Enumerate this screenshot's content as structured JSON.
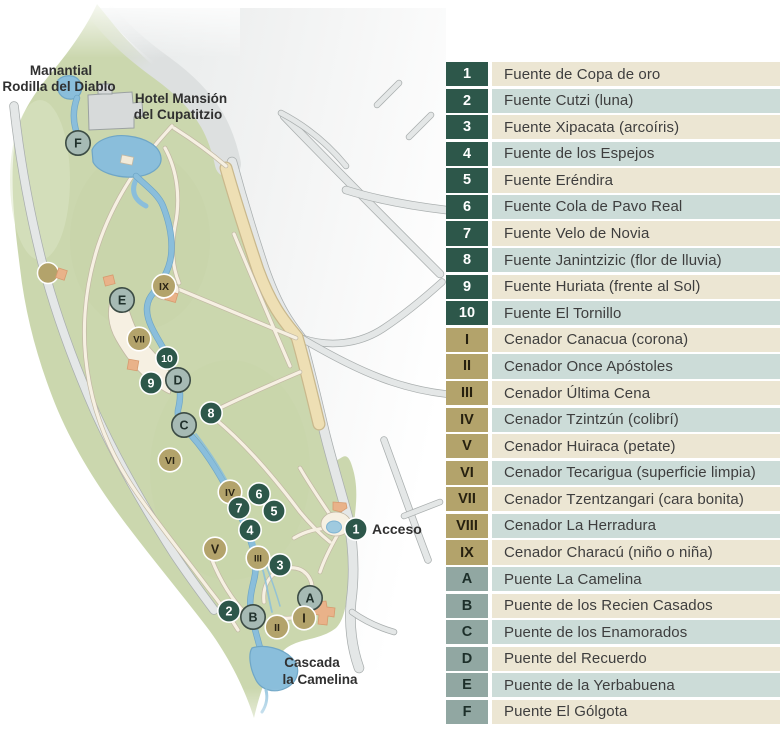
{
  "colors": {
    "fuente_badge": "#2d574a",
    "cenador_badge": "#b3a36b",
    "puente_badge": "#91a7a2",
    "puente_marker": "#a6bab4",
    "row_teal": "#ccdcd8",
    "row_cream": "#ece6d3",
    "park_green": "#cbd7ae",
    "river_blue": "#8abedb",
    "road_gray": "#e4e7e7",
    "avenue_beige": "#eedfb4",
    "building_orange": "#e9b289"
  },
  "legend": {
    "items": [
      {
        "badge": "1",
        "type": "fuente",
        "label": "Fuente de Copa de oro"
      },
      {
        "badge": "2",
        "type": "fuente",
        "label": "Fuente Cutzi (luna)"
      },
      {
        "badge": "3",
        "type": "fuente",
        "label": "Fuente Xipacata (arcoíris)"
      },
      {
        "badge": "4",
        "type": "fuente",
        "label": "Fuente de los Espejos"
      },
      {
        "badge": "5",
        "type": "fuente",
        "label": "Fuente Eréndira"
      },
      {
        "badge": "6",
        "type": "fuente",
        "label": "Fuente Cola de Pavo Real"
      },
      {
        "badge": "7",
        "type": "fuente",
        "label": "Fuente Velo de Novia"
      },
      {
        "badge": "8",
        "type": "fuente",
        "label": "Fuente Janintzizic (flor de lluvia)"
      },
      {
        "badge": "9",
        "type": "fuente",
        "label": "Fuente Huriata (frente al Sol)"
      },
      {
        "badge": "10",
        "type": "fuente",
        "label": "Fuente El Tornillo"
      },
      {
        "badge": "I",
        "type": "cenador",
        "label": "Cenador Canacua (corona)"
      },
      {
        "badge": "II",
        "type": "cenador",
        "label": "Cenador Once Apóstoles"
      },
      {
        "badge": "III",
        "type": "cenador",
        "label": "Cenador Última Cena"
      },
      {
        "badge": "IV",
        "type": "cenador",
        "label": "Cenador Tzintzún (colibrí)"
      },
      {
        "badge": "V",
        "type": "cenador",
        "label": "Cenador Huiraca (petate)"
      },
      {
        "badge": "VI",
        "type": "cenador",
        "label": "Cenador Tecarigua (superficie limpia)"
      },
      {
        "badge": "VII",
        "type": "cenador",
        "label": "Cenador Tzentzangari (cara bonita)"
      },
      {
        "badge": "VIII",
        "type": "cenador",
        "label": "Cenador La Herradura"
      },
      {
        "badge": "IX",
        "type": "cenador",
        "label": "Cenador Characú (niño o niña)"
      },
      {
        "badge": "A",
        "type": "puente",
        "label": "Puente La Camelina"
      },
      {
        "badge": "B",
        "type": "puente",
        "label": "Puente de los Recien Casados"
      },
      {
        "badge": "C",
        "type": "puente",
        "label": "Puente de los Enamorados"
      },
      {
        "badge": "D",
        "type": "puente",
        "label": "Puente del Recuerdo"
      },
      {
        "badge": "E",
        "type": "puente",
        "label": "Puente de la Yerbabuena"
      },
      {
        "badge": "F",
        "type": "puente",
        "label": "Puente El Gólgota"
      }
    ]
  },
  "map": {
    "labels": {
      "manantial_line1": "Manantial",
      "manantial_line2": "Rodilla del Diablo",
      "hotel_line1": "Hotel Mansión",
      "hotel_line2": "del Cupatitzio",
      "acceso": "Acceso",
      "cascada_line1": "Cascada",
      "cascada_line2": "la Camelina"
    },
    "markers": [
      {
        "id": "F",
        "type": "puente",
        "x": 78,
        "y": 143
      },
      {
        "id": "E",
        "type": "puente",
        "x": 122,
        "y": 300
      },
      {
        "id": "IX",
        "type": "cenador",
        "x": 164,
        "y": 286
      },
      {
        "id": "VII",
        "type": "cenador",
        "x": 139,
        "y": 339
      },
      {
        "id": "10",
        "type": "fuente",
        "x": 167,
        "y": 358
      },
      {
        "id": "D",
        "type": "puente",
        "x": 178,
        "y": 380
      },
      {
        "id": "9",
        "type": "fuente",
        "x": 151,
        "y": 383
      },
      {
        "id": "8",
        "type": "fuente",
        "x": 211,
        "y": 413
      },
      {
        "id": "C",
        "type": "puente",
        "x": 184,
        "y": 425
      },
      {
        "id": "VI",
        "type": "cenador",
        "x": 170,
        "y": 460
      },
      {
        "id": "IV",
        "type": "cenador",
        "x": 230,
        "y": 492
      },
      {
        "id": "6",
        "type": "fuente",
        "x": 259,
        "y": 494
      },
      {
        "id": "5",
        "type": "fuente",
        "x": 274,
        "y": 511
      },
      {
        "id": "7",
        "type": "fuente",
        "x": 239,
        "y": 508
      },
      {
        "id": "4",
        "type": "fuente",
        "x": 250,
        "y": 530
      },
      {
        "id": "1",
        "type": "fuente",
        "x": 356,
        "y": 529
      },
      {
        "id": "V",
        "type": "cenador",
        "x": 215,
        "y": 549
      },
      {
        "id": "III",
        "type": "cenador",
        "x": 258,
        "y": 558
      },
      {
        "id": "3",
        "type": "fuente",
        "x": 280,
        "y": 565
      },
      {
        "id": "A",
        "type": "puente",
        "x": 310,
        "y": 598
      },
      {
        "id": "2",
        "type": "fuente",
        "x": 229,
        "y": 611
      },
      {
        "id": "B",
        "type": "puente",
        "x": 253,
        "y": 617
      },
      {
        "id": "II",
        "type": "cenador",
        "x": 277,
        "y": 627
      },
      {
        "id": "I",
        "type": "cenador",
        "x": 304,
        "y": 618
      }
    ]
  }
}
